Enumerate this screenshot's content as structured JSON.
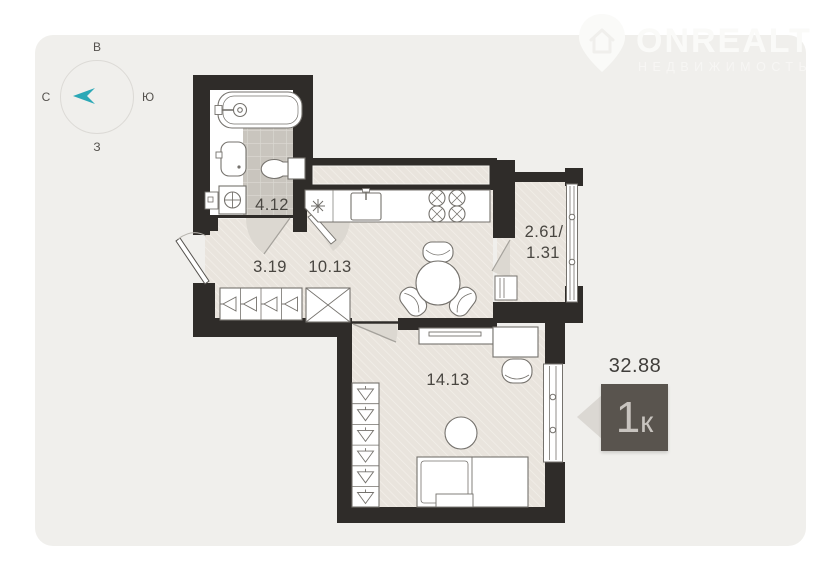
{
  "compass": {
    "letter_top": "В",
    "letter_right": "Ю",
    "letter_bottom": "З",
    "letter_left": "С"
  },
  "watermark": {
    "brand": "ONREALT",
    "subtitle": "НЕДВИЖИМОСТЬ"
  },
  "rooms": {
    "bathroom": "4.12",
    "hallway": "3.19",
    "kitchen": "10.13",
    "balcony_line1": "2.61/",
    "balcony_line2": "1.31",
    "living": "14.13"
  },
  "summary": {
    "total_area": "32.88",
    "flat_type_number": "1",
    "flat_type_letter": "к"
  },
  "colors": {
    "accent_teal": "#2ba8b6",
    "wall": "#2f2c29",
    "floor": "#e9e4dd",
    "tile": "#c9c5be",
    "badge_bg": "#59544e",
    "card_bg": "#f0efec"
  }
}
